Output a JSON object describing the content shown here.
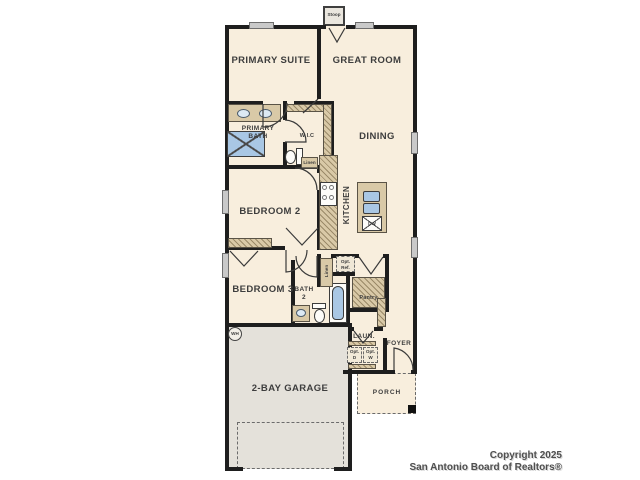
{
  "labels": {
    "stoop": "Stoop",
    "primary_suite": "PRIMARY SUITE",
    "great_room": "GREAT ROOM",
    "primary_bath": "PRIMARY BATH",
    "wic": "W.I.C",
    "dining": "DINING",
    "kitchen": "KITCHEN",
    "linen_wic": "Linen",
    "bedroom2": "BEDROOM 2",
    "bedroom3": "BEDROOM 3",
    "bath2": "BATH 2",
    "linen_bath": "Linen",
    "opt_ref": "Opt. Ref.",
    "pantry": "Pantry",
    "laundry": "LAUN.",
    "foyer": "FOYER",
    "opt_d": "Opt. D",
    "opt_w": "Opt. W",
    "wh": "WH",
    "dw": "DW",
    "garage": "2-BAY GARAGE",
    "porch": "PORCH"
  },
  "footer": {
    "copyright_line1": "Copyright 2025",
    "copyright_line2": "San Antonio Board of Realtors®"
  },
  "colors": {
    "wall": "#1e1e1e",
    "room_fill": "#f8eedd",
    "garage_fill": "#e4e1da",
    "counter_tan": "#d9c9a7",
    "fixture_blue": "#a9c7e4",
    "window_gray": "#c9c9c9"
  }
}
